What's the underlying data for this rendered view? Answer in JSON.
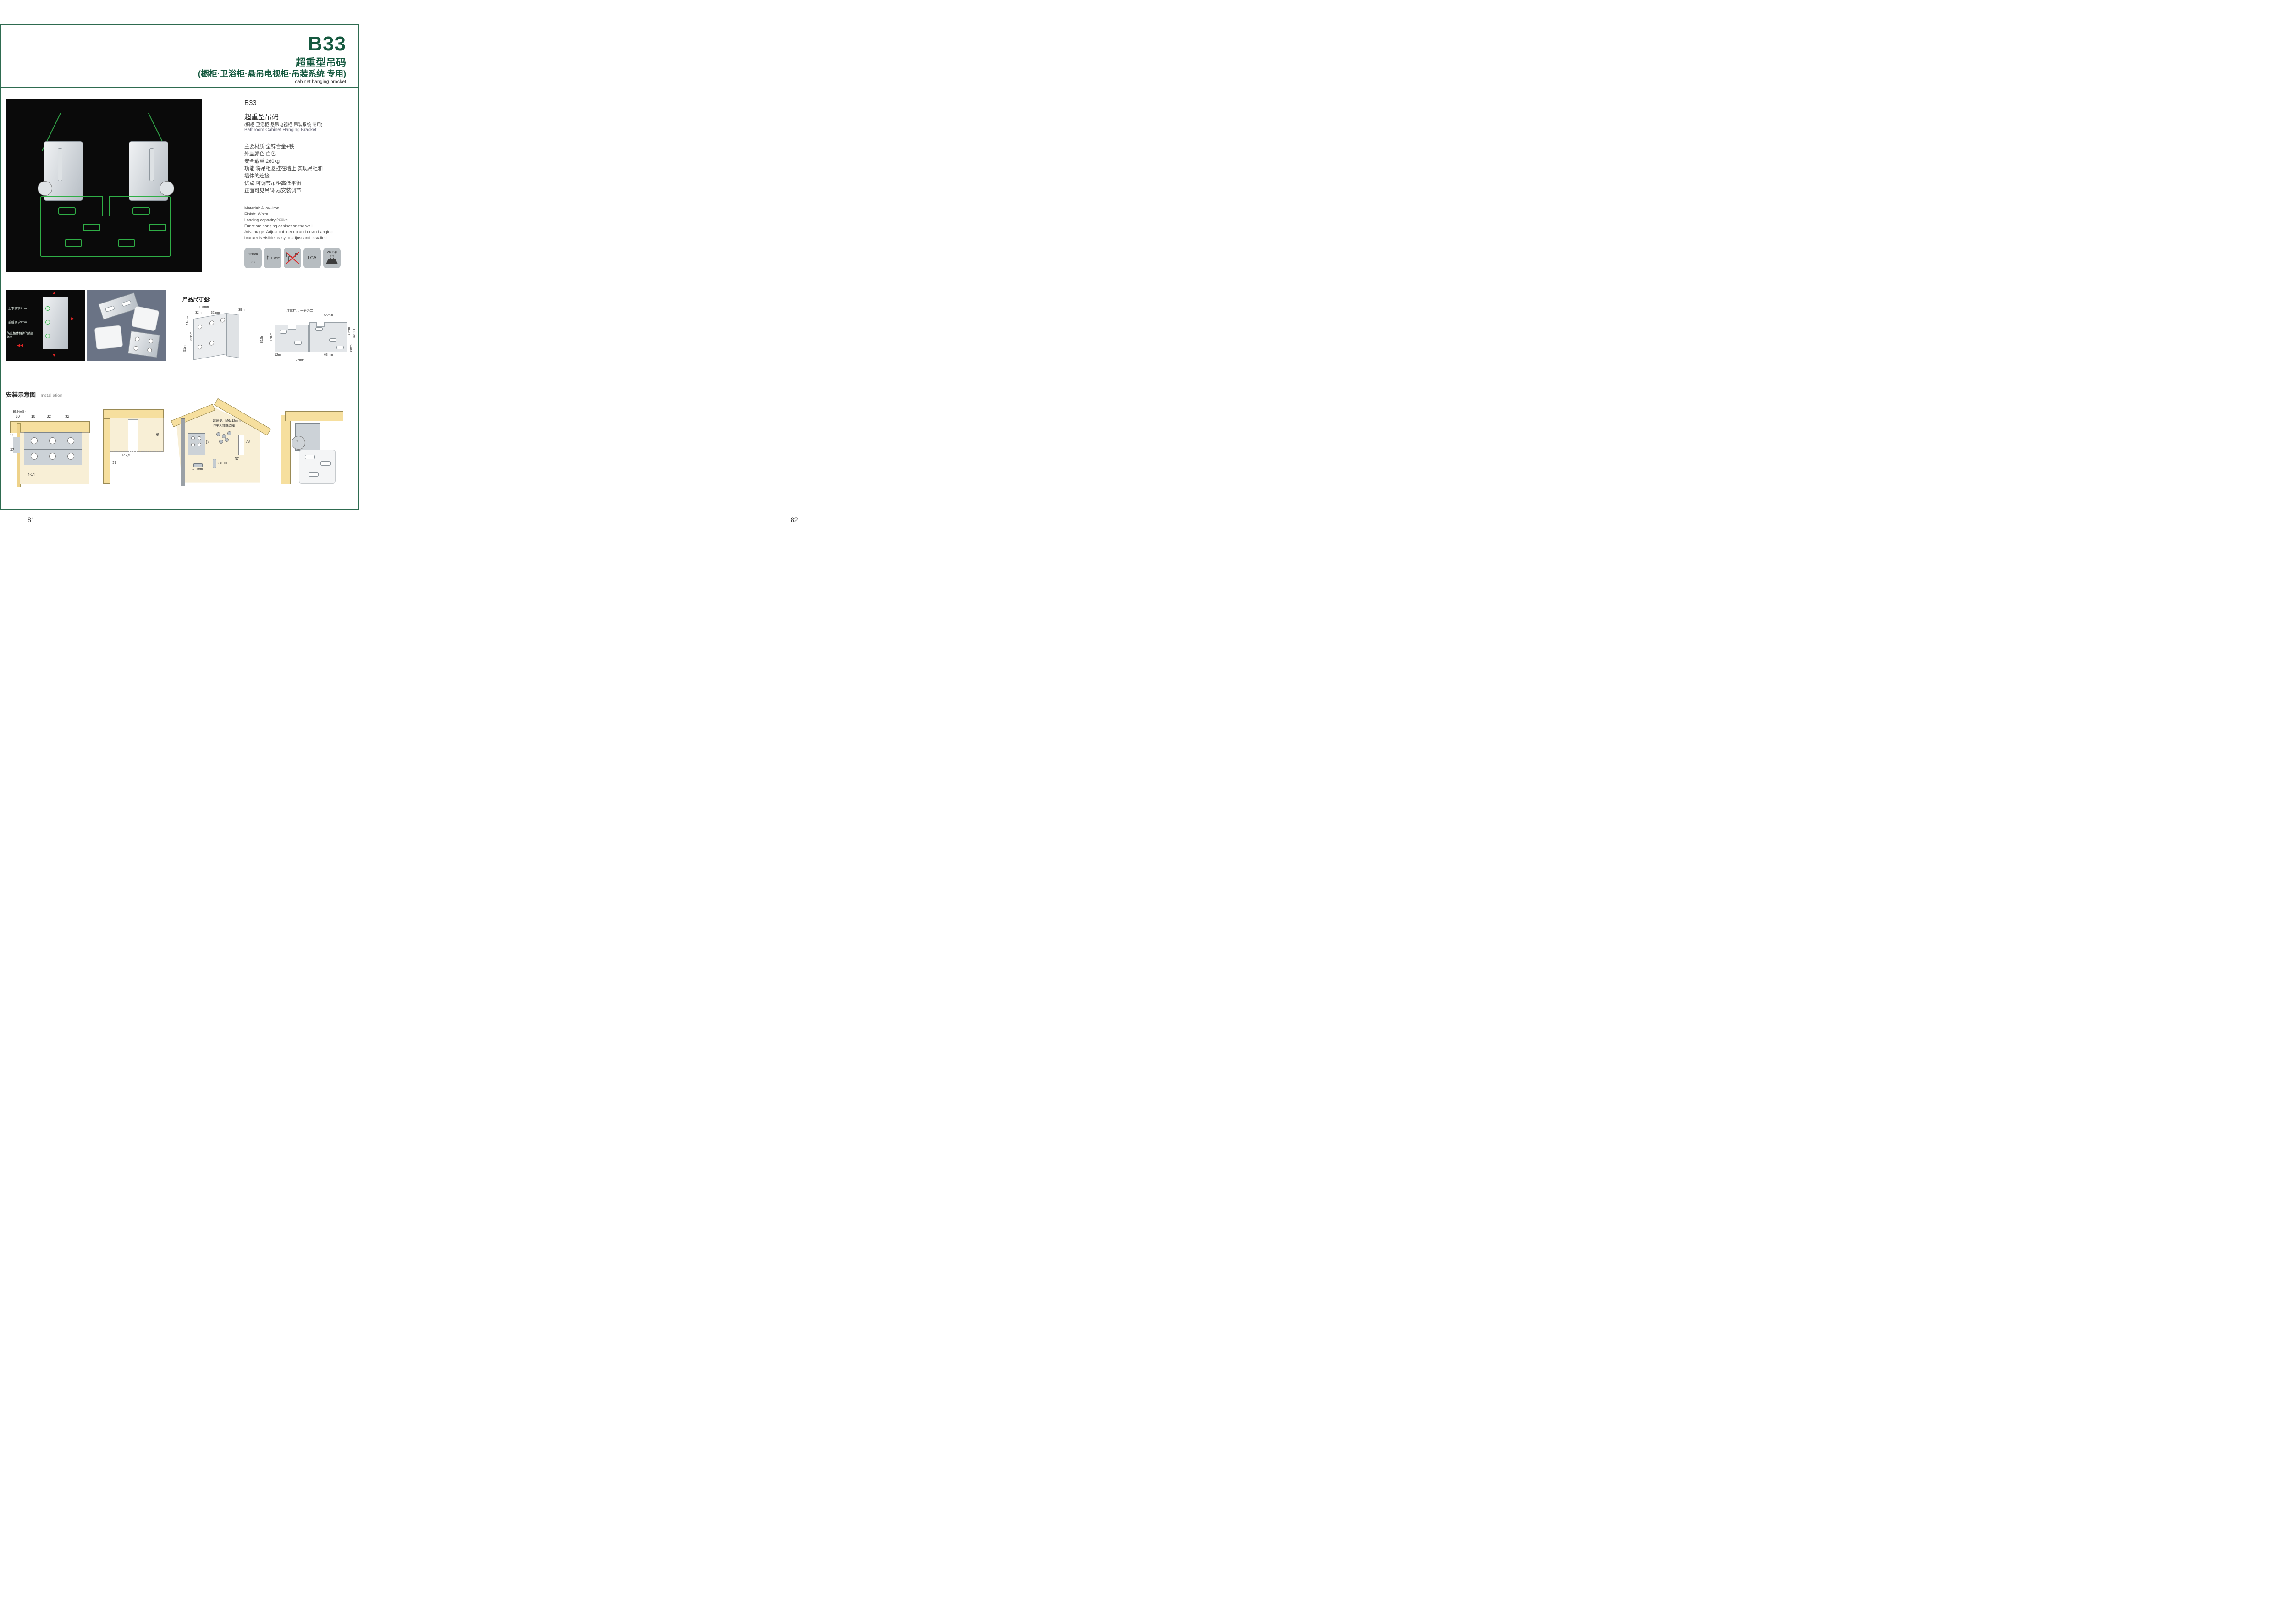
{
  "accent_color": "#15593f",
  "left_page": {
    "page_number": "81",
    "header": {
      "code": "B17",
      "title_cn": "全钢重型吊码",
      "subtitle_en": "cabinet hanging bracket"
    },
    "info": {
      "code": "B17",
      "name_cn": "全钢重型吊码",
      "name_en": "Cabinet Hanging Bracket",
      "specs_cn": [
        "主要材质:ABS塑料+铁",
        "表面处理:白色、灰色、棕色",
        "安全载重:80kg",
        "功能:将吊柜悬挂在墙上,实现吊柜和",
        "墙体的连接",
        "优点:可调节吊柜高低平衡",
        "正面可见吊码,易安装调节"
      ],
      "specs_en": [
        "Material: ABS+iron",
        "Finish: White, gray, brown",
        "Loading capacity: 120kg",
        "Function: hanging cabinet on the wall",
        "Advantage: Adjust cabinet up and down hanging",
        "bracket is visible, easy to adjust and installed"
      ]
    },
    "icons": [
      {
        "name": "width-arrow-icon",
        "label": "10mm"
      },
      {
        "name": "height-arrow-icon",
        "label": "15mm"
      },
      {
        "name": "no-drill-icon",
        "label": ""
      },
      {
        "name": "lga-badge",
        "label": "LGA"
      },
      {
        "name": "load-weight-icon",
        "label": "120Kg"
      }
    ],
    "color_options": {
      "heading": "盖子可选颜色",
      "items": [
        {
          "caption": "灰色盖(Gray Cap)",
          "cap_color": "#85888b"
        },
        {
          "caption": "白色盖(White Cap )",
          "cap_color": "#f6f8f9"
        },
        {
          "caption": "棕色 (Brown Cap)",
          "cap_color": "#5a2e31"
        }
      ]
    },
    "installation": {
      "heading_cn": "安装示意图",
      "heading_en": "Installation",
      "d1": {
        "w": "10mm",
        "h": "15mm"
      },
      "d2": {
        "qty": "2x",
        "dia": "φ4mm",
        "t": "13",
        "min": "MIN.10",
        "max": "MAX.30",
        "len": "78"
      },
      "d3": {
        "a": "34",
        "b": "32",
        "r": "RMAX4",
        "c": "18",
        "d": "20",
        "e": "32"
      }
    }
  },
  "right_page": {
    "page_number": "82",
    "header": {
      "code": "B33",
      "title_cn": "超重型吊码",
      "title_cn2": "(橱柜·卫浴柜·悬吊电视柜·吊装系统 专用)",
      "subtitle_en": "cabinet hanging bracket"
    },
    "info": {
      "code": "B33",
      "name_cn": "超重型吊码",
      "name_cn2": "(橱柜·卫浴柜·悬吊电视柜·吊装系统 专用)",
      "name_en": "Bathroom Cabinet Hanging Bracket",
      "specs_cn": [
        "主要材质:全锌合金+铁",
        "外盖颜色:白色",
        "安全载重:260kg",
        "功能:将吊柜悬挂在墙上,实现吊柜和",
        "墙体的连接",
        "优点:可调节吊柜高低平衡",
        "正面可见吊码,易安装调节"
      ],
      "specs_en": [
        "Material: Alloy+iron",
        "Finish: White",
        "Loading capacity:260kg",
        "Function: hanging cabinet on the wall",
        "Advantage: Adjust cabinet up and down hanging",
        "bracket is visible, easy to adjust and installed"
      ]
    },
    "icons": [
      {
        "name": "width-arrow-icon",
        "label": "12mm"
      },
      {
        "name": "height-arrow-icon",
        "label": "13mm"
      },
      {
        "name": "no-drill-icon",
        "label": ""
      },
      {
        "name": "lga-badge",
        "label": "LGA"
      },
      {
        "name": "load-weight-icon",
        "label": "260Kg"
      }
    ],
    "feature_photo": {
      "labels": [
        "上下调节9mm",
        "前后调节9mm",
        "防止柜体翻转的锁紧螺丝"
      ]
    },
    "dimensions": {
      "heading": "产品尺寸图:",
      "bracket": {
        "w": "104mm",
        "d": "39mm",
        "p1": "32mm",
        "p2": "32mm",
        "e1": "11mm",
        "e2": "32mm",
        "e3": "51mm",
        "h": "80.5mm"
      },
      "plate": {
        "note": "连体挂片 一分为二",
        "a": "55mm",
        "b": "39mm",
        "c": "55mm",
        "d": "17mm",
        "e": "8mm",
        "f": "12mm",
        "g": "63mm",
        "h": "77mm"
      }
    },
    "installation": {
      "heading_cn": "安装示意图",
      "heading_en": "Installation",
      "d1": {
        "note": "最小间距",
        "a": "20",
        "b": "10",
        "c": "32",
        "d": "32",
        "e": "11",
        "f": "32",
        "g": "4-14"
      },
      "d2": {
        "a": "78",
        "b": "R 2,5",
        "c": "37"
      },
      "d3": {
        "note1": "建议使用M6x12mm",
        "note2": "的平头螺丝固定",
        "a": "78",
        "b": "37",
        "c": "9mm",
        "d": "9mm"
      }
    }
  }
}
